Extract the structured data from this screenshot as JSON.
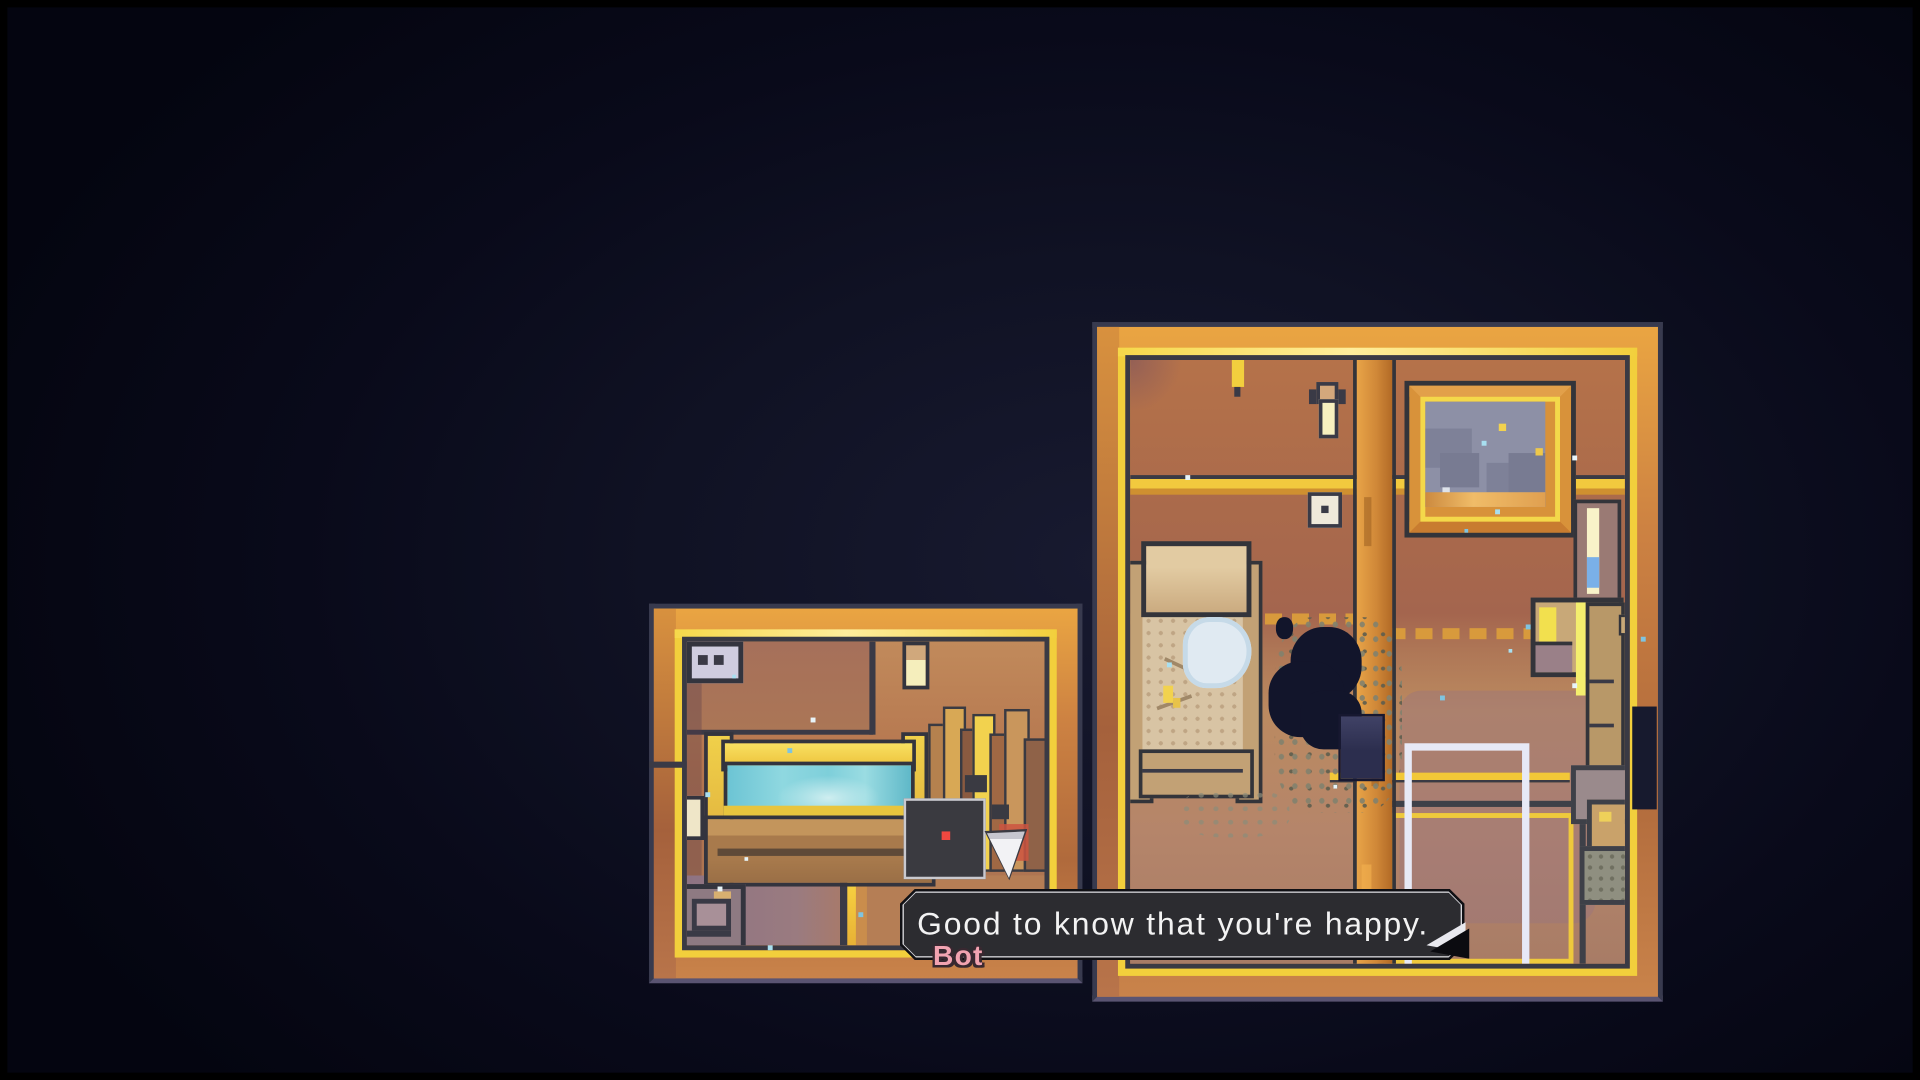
{
  "dialogue": {
    "text": "Good to know that you're happy.",
    "speaker": "Bot"
  },
  "icons": {
    "advance_indicator": "dialogue-advance-arrow",
    "player_marker": "triangle-character"
  },
  "palette": {
    "bg-center": "#181a30",
    "bg-edge": "#040510",
    "room-outline": "#383a4e",
    "room-outline-bottom": "#5a5472",
    "frame-yellow": "#f2cf3c",
    "wall-orange": "#c27a45",
    "glass-teal": "#7ed2de",
    "window-night": "#8d90a6",
    "box-bg": "#2c2c30",
    "box-border": "#d8d8dd",
    "box-outline": "#101014",
    "dialogue-text": "#f3f3f3",
    "speaker-pink": "#f2a3b1",
    "bot-body": "#3a3a40",
    "bot-eye": "#f04840",
    "triangle-white": "#f2f2f5",
    "creature-dark": "#12152b",
    "door-white": "#e7e9f6"
  }
}
